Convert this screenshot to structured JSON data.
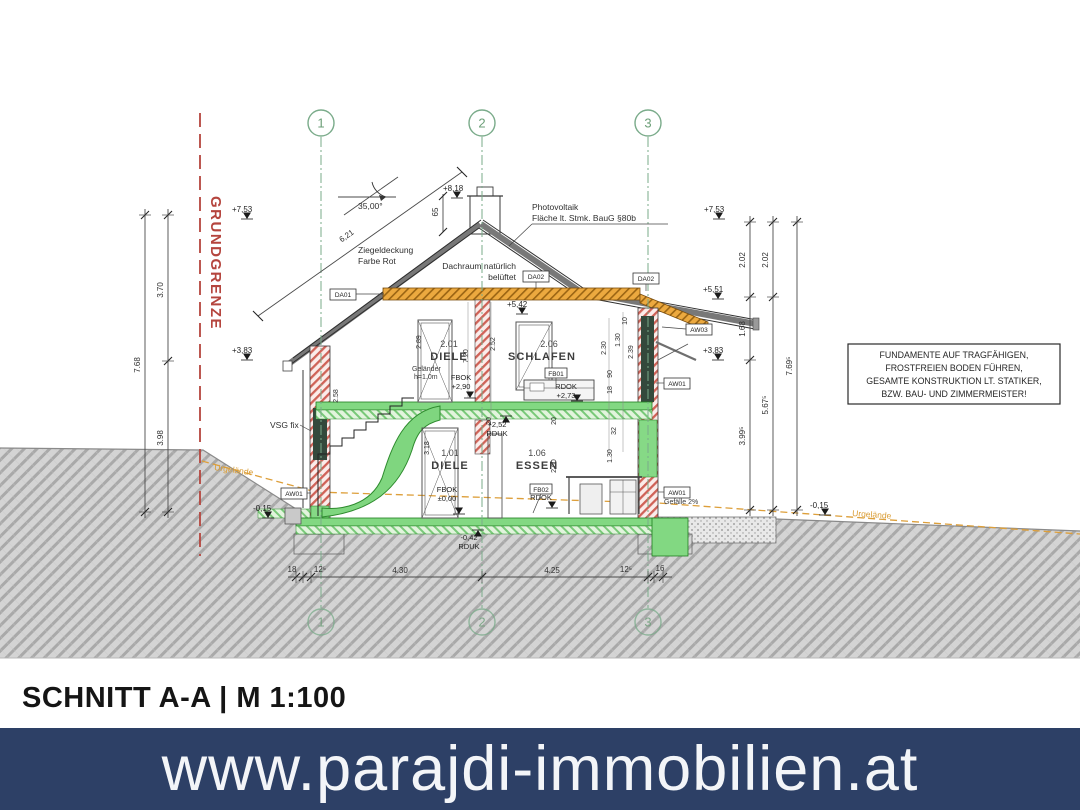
{
  "colors": {
    "banner_bg": "#2d4066",
    "banner_text": "#f3f5f8",
    "grid_green": "#7aab8a",
    "boundary_red": "#b5453e",
    "terrain_orange": "#dd9f3a",
    "timber_orange": "#eca93f",
    "slab_green": "#82d882",
    "wall_hatch_red": "#cf6257"
  },
  "banner": {
    "url": "www.parajdi-immobilien.at"
  },
  "title": "SCHNITT A-A | M 1:100",
  "boundary_label": "GRUNDGRENZE",
  "grid": {
    "g1": "1",
    "g2": "2",
    "g3": "3"
  },
  "note_box": {
    "l1": "FUNDAMENTE AUF TRAGFÄHIGEN,",
    "l2": "FROSTFREIEN BODEN FÜHREN,",
    "l3": "GESAMTE KONSTRUKTION LT. STATIKER,",
    "l4": "BZW. BAU- UND ZIMMERMEISTER!"
  },
  "annotations": {
    "roof_angle": "35,00°",
    "tile1": "Ziegeldeckung",
    "tile2": "Farbe Rot",
    "attic1": "Dachraum natürlich",
    "attic2": "belüftet",
    "pv1": "Photovoltaik",
    "pv2": "Fläche lt. Stmk. BauG §80b",
    "rail1": "Geländer",
    "rail2": "h=1.0m",
    "vsg": "VSG fix",
    "terrain": "Urgelände",
    "slope": "Gefälle 2%"
  },
  "rooms": {
    "r201no": "2.01",
    "r201": "DIELE",
    "r206no": "2.06",
    "r206": "SCHLAFEN",
    "r101no": "1.01",
    "r101": "DIELE",
    "r106no": "1.06",
    "r106": "ESSEN"
  },
  "tags": {
    "da01": "DA01",
    "da02": "DA02",
    "aw03": "AW03",
    "aw01": "AW01",
    "fb01": "FB01",
    "fb02": "FB02"
  },
  "levels": {
    "ridge": "+8,18",
    "eaves_l": "+7,53",
    "eaves_r": "+7,53",
    "mid_r": "+5,51",
    "ceil": "+5,42",
    "upper_l": "+3,83",
    "upper_r": "+3,83",
    "gnd_l": "-0,15",
    "gnd_r": "-0,15",
    "fbok": "FBOK",
    "rdok": "RDOK",
    "rduk": "RDUK",
    "v290": "+2,90",
    "v273": "+2,73",
    "v252": "+2,52",
    "v000": "±0,00",
    "v042": "-0,42"
  },
  "dims": {
    "left_total": "7.68",
    "left_up": "3.70",
    "left_low": "3.98",
    "ra1": "2.02",
    "ra2": "1.68",
    "ra3": "3.99⁵",
    "rb1": "2.02",
    "rb2": "5.67⁵",
    "rc": "7.69⁵",
    "b1": "18",
    "b2": "12⁵",
    "b3": "4.30",
    "b4": "4.25",
    "b5": "12⁵",
    "b6": "16",
    "ridge_h": "65",
    "roof_len": "6,21",
    "i258": "2.58",
    "i289": "2.89",
    "i720": "7.20",
    "i252": "2.52",
    "i318": "3.18",
    "i260": "2.60",
    "i230": "2.30",
    "i130a": "1.30",
    "i10": "10",
    "i239": "2.39",
    "i90": "90",
    "i18": "18",
    "i20a": "20",
    "i20b": "20",
    "i32": "32",
    "i130b": "1.30"
  }
}
